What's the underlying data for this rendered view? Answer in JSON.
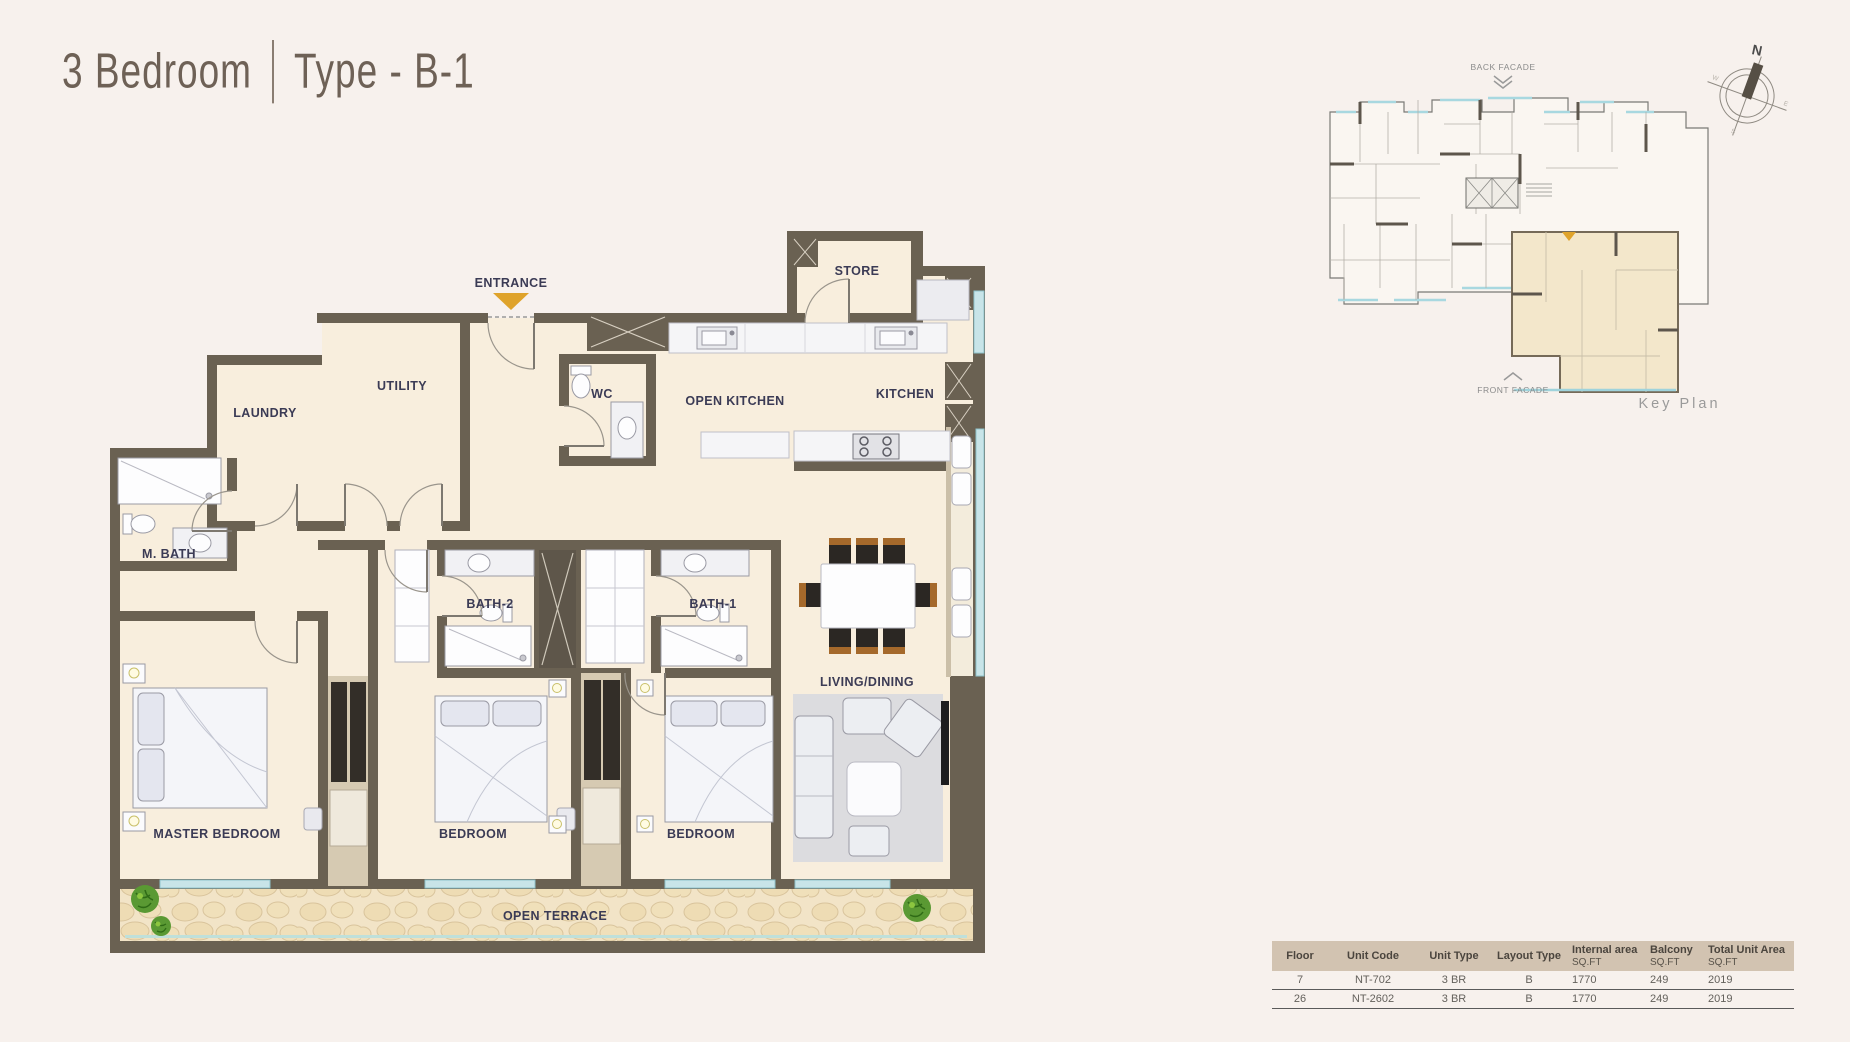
{
  "title": {
    "name": "3 Bedroom",
    "divider": "|",
    "variant": "Type - B-1"
  },
  "plan": {
    "entrance": "ENTRANCE",
    "rooms": {
      "laundry": "LAUNDRY",
      "utility": "UTILITY",
      "wc": "WC",
      "open_kitchen": "OPEN KITCHEN",
      "kitchen": "KITCHEN",
      "store": "STORE",
      "m_bath": "M. BATH",
      "bath2": "BATH-2",
      "bath1": "BATH-1",
      "living_dining": "LIVING/DINING",
      "master_bedroom": "MASTER BEDROOM",
      "bedroom_2": "BEDROOM",
      "bedroom_3": "BEDROOM",
      "open_terrace": "OPEN TERRACE"
    }
  },
  "key_plan": {
    "back_facade": "BACK FACADE",
    "front_facade": "FRONT FACADE",
    "caption": "Key Plan",
    "compass": {
      "north": "N",
      "west": "W",
      "east": "E",
      "south": "S"
    }
  },
  "unit_table": {
    "headers": [
      {
        "line1": "Floor",
        "line2": ""
      },
      {
        "line1": "Unit Code",
        "line2": ""
      },
      {
        "line1": "Unit Type",
        "line2": ""
      },
      {
        "line1": "Layout Type",
        "line2": ""
      },
      {
        "line1": "Internal area",
        "line2": "SQ.FT"
      },
      {
        "line1": "Balcony",
        "line2": "SQ.FT"
      },
      {
        "line1": "Total Unit Area",
        "line2": "SQ.FT"
      }
    ],
    "rows": [
      [
        "7",
        "NT-702",
        "3 BR",
        "B",
        "1770",
        "249",
        "2019"
      ],
      [
        "26",
        "NT-2602",
        "3 BR",
        "B",
        "1770",
        "249",
        "2019"
      ]
    ]
  },
  "colors": {
    "page_bg": "#f7f1ed",
    "wall": "#6a6152",
    "room_fill": "#f8eedd",
    "terrace_fill": "#f2e4c7",
    "accent_gold": "#dfa32b",
    "label_text": "#3b3b55",
    "window_glass": "#c8e4e8",
    "table_header_bg": "#d2c3b1",
    "title_text": "#6e6156"
  }
}
